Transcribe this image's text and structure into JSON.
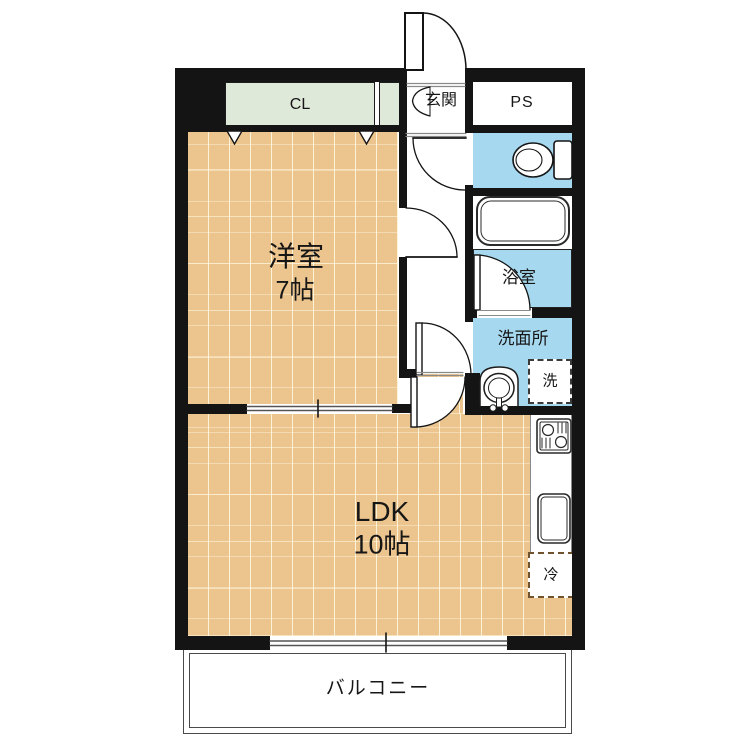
{
  "rooms": {
    "closet_label": "CL",
    "entrance_label": "玄関",
    "pipe_space_label": "PS",
    "western_room_name": "洋室",
    "western_room_size": "7帖",
    "ldk_name": "LDK",
    "ldk_size": "10帖",
    "bathroom_label": "浴室",
    "washroom_label": "洗面所",
    "washer_label": "洗",
    "fridge_label": "冷",
    "balcony_label": "バルコニー"
  },
  "colors": {
    "wall": "#141414",
    "wood_floor": "#ecc48d",
    "water_blue": "#a6d9ef",
    "closet_green": "#dfe9da"
  }
}
